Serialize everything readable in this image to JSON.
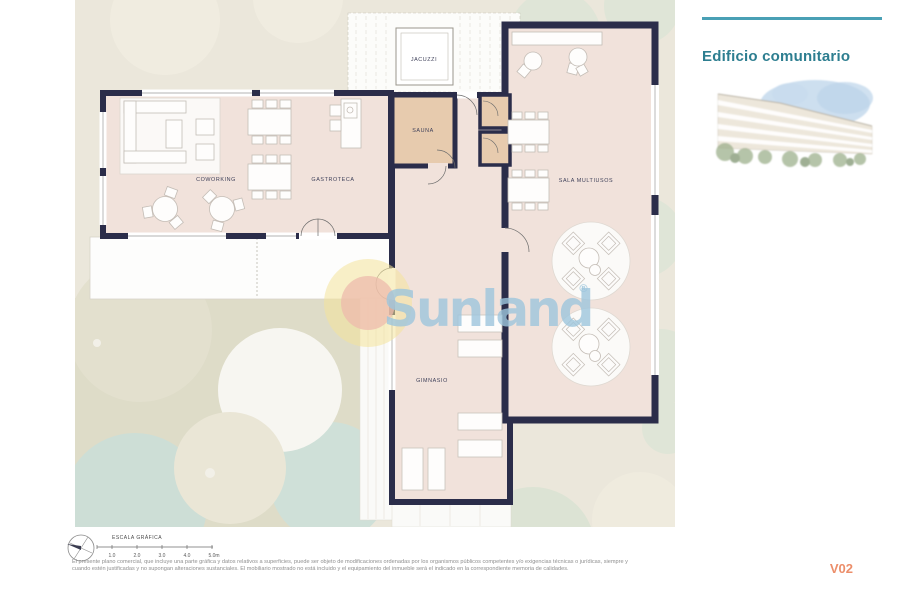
{
  "header": {
    "title": "Edificio comunitario"
  },
  "rooms": {
    "jacuzzi": "JACUZZI",
    "sauna": "SAUNA",
    "coworking": "COWORKING",
    "gastroteca": "GASTROTECA",
    "sala_multiusos": "SALA MULTIUSOS",
    "gimnasio": "GIMNASIO"
  },
  "watermark": {
    "brand": "Sunland",
    "registered": "®"
  },
  "scale_bar": {
    "title": "ESCALA GRÁFICA",
    "ticks": [
      "1.0",
      "2.0",
      "3.0",
      "4.0",
      "5.0m"
    ]
  },
  "footer": {
    "disclaimer_line1": "El presente plano comercial, que incluye una parte gráfica y datos relativos a superficies, puede ser objeto de modificaciones ordenadas por los organismos públicos competentes y/o exigencias técnicas o jurídicas, siempre y",
    "disclaimer_line2": "cuando estén justificadas y no supongan alteraciones sustanciales. El mobiliario mostrado no está incluido y el equipamiento del inmueble será el indicado en la correspondiente memoria de calidades.",
    "version": "V02"
  },
  "colors": {
    "wall": "#2B2D4A",
    "floor": "#F1E2DB",
    "sauna_floor": "#E7CBAE",
    "site": "#EBE7DB",
    "garden": "#DEDCC8",
    "tree": "#DFE5D7",
    "accent_teal": "#49A0B5",
    "title_teal": "#2D7E90",
    "version_orange": "#EC8E6A",
    "watermark_blue": "#9EC6DD"
  }
}
